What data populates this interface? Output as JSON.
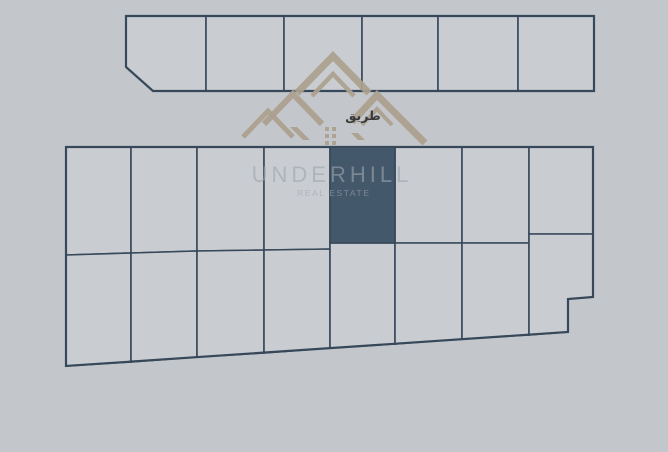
{
  "canvas": {
    "width": 668,
    "height": 452
  },
  "colors": {
    "background": "#c3c7cb",
    "plot_fill": "#c9cdd1",
    "plot_line": "#37485a",
    "highlight_fill": "#44586c",
    "logo_tan": "#aca08e",
    "watermark_text": "rgba(158,165,173,0.62)",
    "road_label_text": "#3a3a3a"
  },
  "watermark": {
    "brand": "UNDERHILL",
    "tagline": "REAL ESTATE"
  },
  "road_label": {
    "text": "طريق"
  },
  "site_plan": {
    "upper_row_outline": "126,16 594,16 594,91 153,91 126,67",
    "upper_row_plots": [
      "126,16 206,16 206,91 153,91 126,67",
      "206,16 284,16 284,91 206,91",
      "284,16 362,16 362,91 284,91",
      "362,16 438,16 438,91 362,91",
      "438,16 518,16 518,91 438,91",
      "518,16 594,16 594,91 518,91"
    ],
    "lower_block_outline": "66,147 593,147 593,297 568,299 568,332 66,366",
    "lower_block_plots": [
      "66,147 131,147 131,253 66,255",
      "131,147 197,147 197,251 131,253",
      "197,147 264,147 264,250 197,251",
      "264,147 330,147 330,249 264,250",
      "395,147 462,147 462,243 395,243",
      "462,147 529,147 529,243 462,243",
      "529,147 593,147 593,234 529,234",
      "66,255 131,253 131,362 66,366",
      "131,253 197,251 197,357 131,362",
      "197,251 264,250 264,353 197,357",
      "264,250 330,249 330,348 264,353",
      "330,243 395,243 395,344 330,348",
      "395,243 462,243 462,339 395,344",
      "462,243 529,243 529,335 462,339",
      "529,234 593,234 593,297 568,299 568,332 529,335"
    ],
    "highlighted_plot": "330,147 395,147 395,243 330,243"
  },
  "logo": {
    "chevrons": [
      {
        "path": "M297,93 L333,56 L369,93",
        "width": 7
      },
      {
        "path": "M312,96 L333,74 L354,96",
        "width": 4.5
      },
      {
        "path": "M264,124 L293,94 L322,124",
        "width": 6
      },
      {
        "path": "M243,137 L268,111 L293,137",
        "width": 5
      },
      {
        "path": "M352,122 L377,95 L425,143",
        "width": 7
      },
      {
        "path": "M362,125 L377,109 L392,125",
        "width": 4
      }
    ],
    "solids": [
      "290,127 303,140 310,140 297,127",
      "351,133 358,140 365,140 358,133"
    ],
    "window_squares": [
      [
        325,
        127
      ],
      [
        332,
        127
      ],
      [
        325,
        134
      ],
      [
        332,
        134
      ],
      [
        325,
        141
      ],
      [
        332,
        141
      ]
    ],
    "window_square_size": 4
  }
}
